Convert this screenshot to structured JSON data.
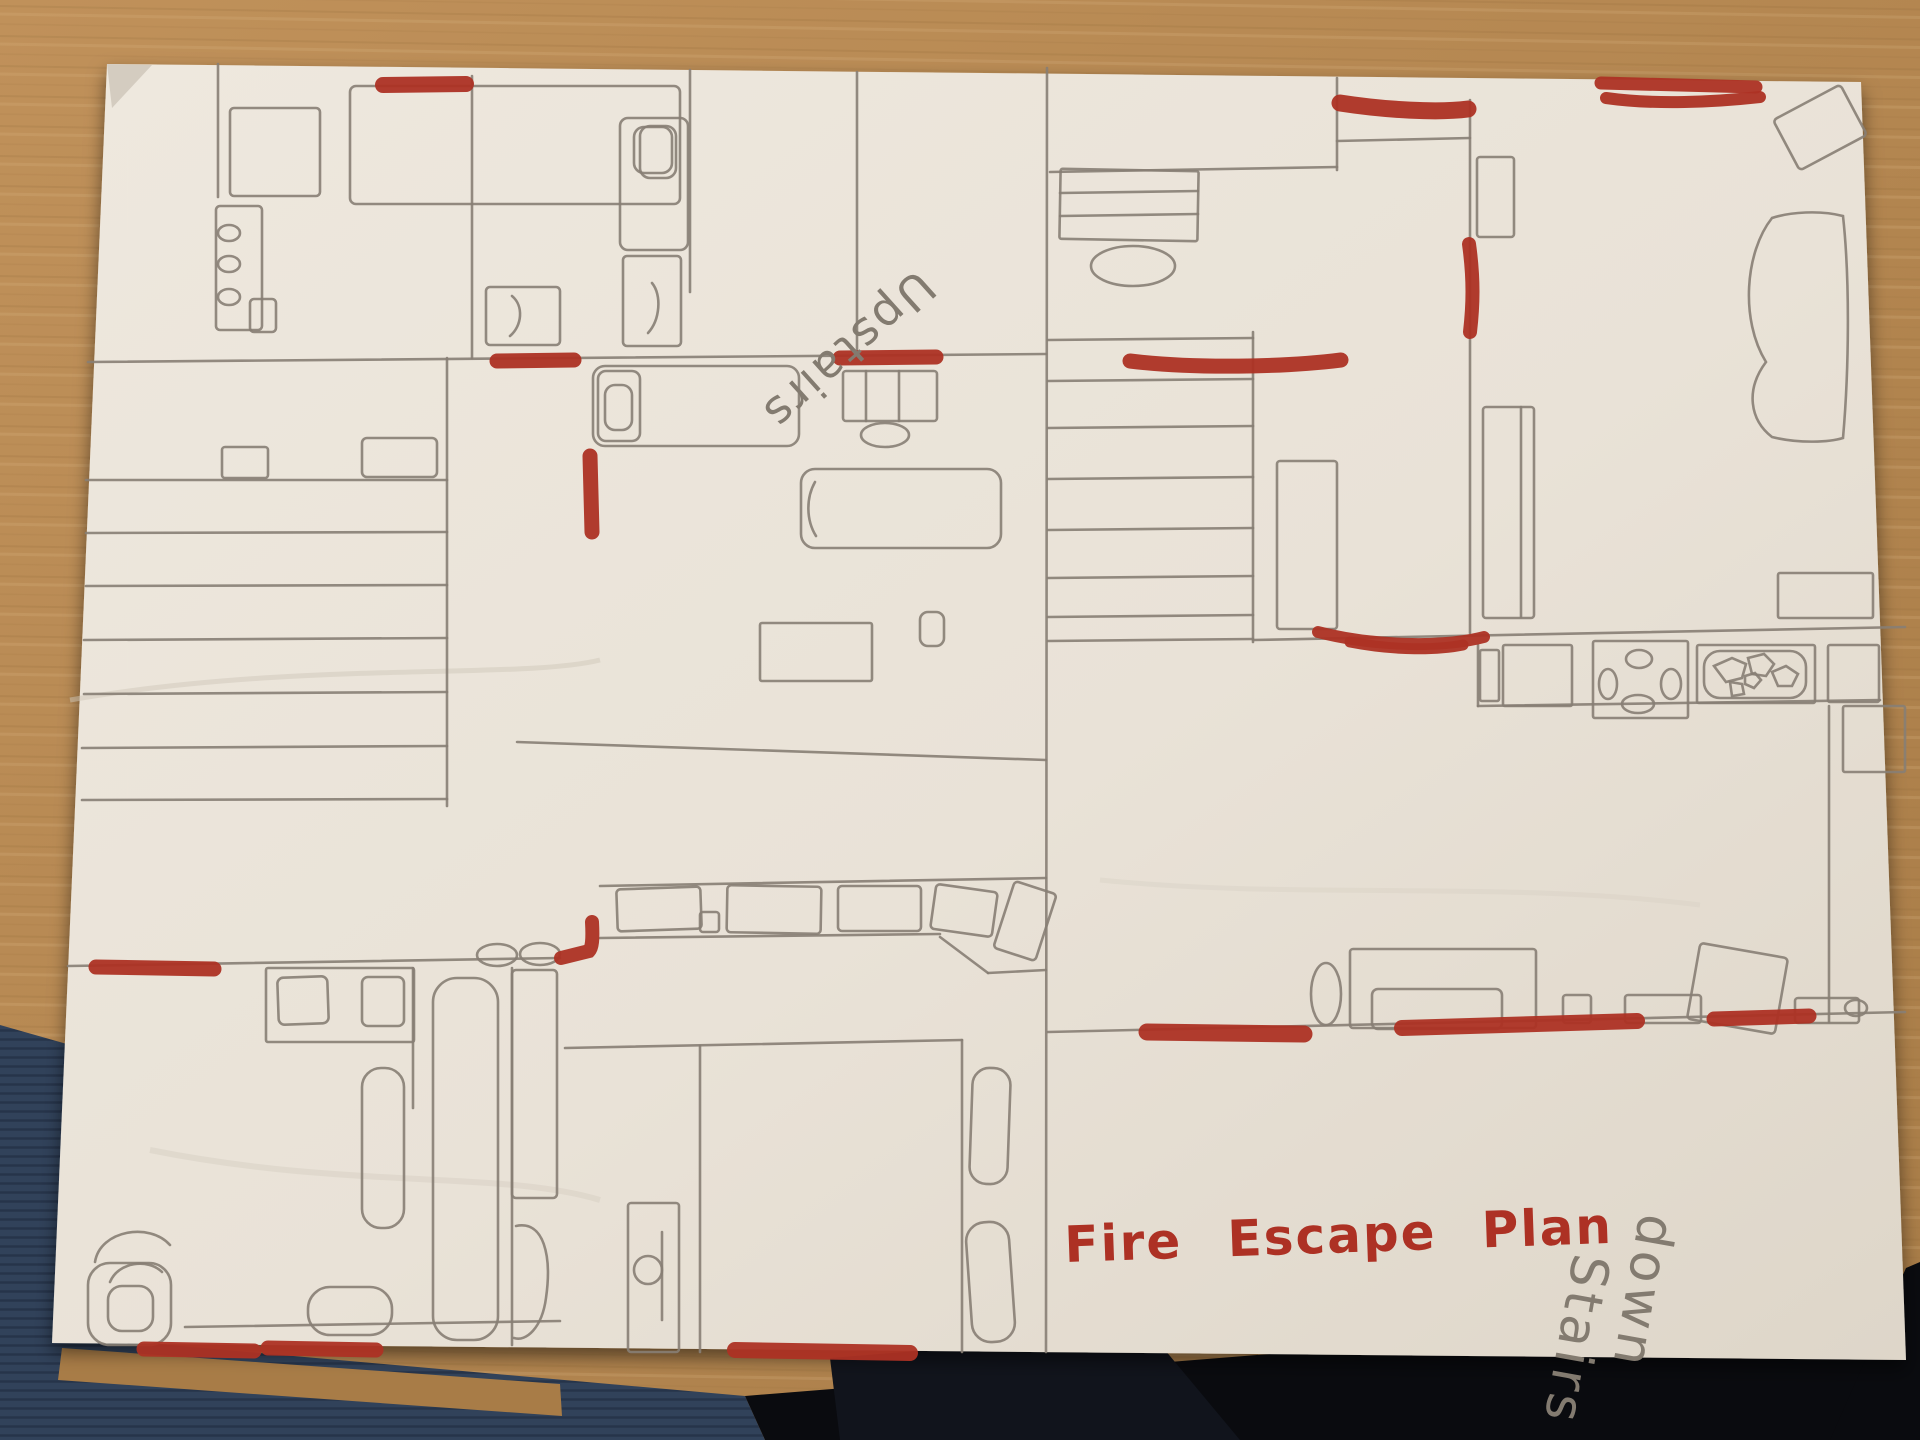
{
  "scene": {
    "description": "Photo of a hand-drawn fire escape plan on white paper lying on a wooden table",
    "floors": [
      "Upstairs",
      "down Stairs"
    ]
  },
  "palette": {
    "wood": "#c0915a",
    "wood_dark": "#a87c47",
    "wood_grain": "#8a6130",
    "wood_light": "#dab583",
    "fabric_navy": "#31425a",
    "fabric_line": "#26344a",
    "shadow_black": "#0a0b0f",
    "paper": "#e9e2d7",
    "paper_edge": "#d4ccc0",
    "pencil": "#877e74",
    "pencil_text": "#837b70",
    "marker_red": "#ad3124"
  },
  "texts": [
    {
      "name": "label-upstairs",
      "text": "Upstairs",
      "x": 917,
      "y": 268,
      "size": 46,
      "rot": 138,
      "color": "pencil_text",
      "weight": "normal",
      "spacing": 3,
      "word": 0
    },
    {
      "name": "label-downstairs-line1",
      "text": "down",
      "x": 1640,
      "y": 1212,
      "size": 52,
      "rot": 100,
      "color": "pencil_text",
      "weight": "normal",
      "spacing": 4,
      "word": 0
    },
    {
      "name": "label-downstairs-line2",
      "text": "Stairs",
      "x": 1574,
      "y": 1252,
      "size": 52,
      "rot": 100,
      "color": "pencil_text",
      "weight": "normal",
      "spacing": 4,
      "word": 0
    },
    {
      "name": "title-fire-escape-plan",
      "text": "Fire Escape Plan",
      "x": 1065,
      "y": 1262,
      "size": 50,
      "rot": -2,
      "color": "marker_red",
      "weight": "bold",
      "spacing": 2,
      "word": 26
    }
  ],
  "red_marks": [
    {
      "name": "exit-top-left-bedroom",
      "d": "M383,85 L466,84",
      "w": 16
    },
    {
      "name": "exit-top-right-wall",
      "d": "M1340,103 C1385,110 1438,113 1468,109",
      "w": 17
    },
    {
      "name": "exit-top-corner-stroke1",
      "d": "M1601,83 L1756,87",
      "w": 13
    },
    {
      "name": "exit-top-corner-stroke2",
      "d": "M1606,98 C1655,105 1715,102 1760,97",
      "w": 12
    },
    {
      "name": "exit-right-wall-vertical",
      "d": "M1469,244 C1474,280 1473,306 1470,332",
      "w": 14
    },
    {
      "name": "exit-midleft-door",
      "d": "M497,361 L574,360",
      "w": 15
    },
    {
      "name": "exit-center-door",
      "d": "M840,358 L936,357",
      "w": 15
    },
    {
      "name": "exit-right-of-center-door",
      "d": "M1130,361 C1195,369 1285,367 1341,360",
      "w": 15
    },
    {
      "name": "exit-middle-vertical-door",
      "d": "M590,456 L592,532",
      "w": 15
    },
    {
      "name": "exit-left-bathroom-wall",
      "d": "M96,967 L214,969",
      "w": 15
    },
    {
      "name": "exit-corridor-L-mark",
      "d": "M592,922 C593,940 592,948 589,951 L561,958",
      "w": 14
    },
    {
      "name": "exit-kitchen-curve1",
      "d": "M1318,632 C1372,646 1442,648 1484,637",
      "w": 12
    },
    {
      "name": "exit-kitchen-curve2",
      "d": "M1350,642 C1396,651 1438,650 1463,645",
      "w": 11
    },
    {
      "name": "exit-living-bottom-left",
      "d": "M1147,1032 L1304,1034",
      "w": 17
    },
    {
      "name": "exit-living-bottom-center",
      "d": "M1402,1028 L1637,1021",
      "w": 16
    },
    {
      "name": "exit-living-bottom-right",
      "d": "M1714,1019 L1809,1016",
      "w": 15
    },
    {
      "name": "exit-paper-bottom-center",
      "d": "M735,1350 L910,1353",
      "w": 16
    },
    {
      "name": "exit-bathroom-bottom1",
      "d": "M144,1349 L254,1351",
      "w": 15
    },
    {
      "name": "exit-bathroom-bottom2",
      "d": "M268,1348 L376,1350",
      "w": 15
    }
  ],
  "drawing": {
    "lines": [
      [
        88,
        362,
        1046,
        354
      ],
      [
        472,
        76,
        472,
        358
      ],
      [
        690,
        70,
        690,
        292
      ],
      [
        857,
        72,
        857,
        356
      ],
      [
        1047,
        68,
        1046,
        1352
      ],
      [
        218,
        64,
        218,
        197
      ],
      [
        447,
        358,
        447,
        806
      ],
      [
        86,
        480,
        447,
        480
      ],
      [
        86,
        533,
        447,
        532
      ],
      [
        86,
        586,
        447,
        585
      ],
      [
        84,
        640,
        447,
        638
      ],
      [
        84,
        694,
        447,
        692
      ],
      [
        82,
        748,
        447,
        746
      ],
      [
        82,
        800,
        447,
        799
      ],
      [
        68,
        966,
        560,
        958
      ],
      [
        940,
        937,
        988,
        973
      ],
      [
        988,
        973,
        1046,
        970
      ],
      [
        600,
        886,
        1046,
        878
      ],
      [
        600,
        938,
        940,
        934
      ],
      [
        565,
        1048,
        962,
        1040
      ],
      [
        700,
        1046,
        700,
        1352
      ],
      [
        962,
        1040,
        962,
        1352
      ],
      [
        517,
        742,
        1046,
        760
      ],
      [
        413,
        968,
        413,
        1108
      ],
      [
        512,
        968,
        512,
        1345
      ],
      [
        185,
        1327,
        560,
        1321
      ],
      [
        866,
        371,
        866,
        421
      ],
      [
        899,
        371,
        899,
        421
      ],
      [
        662,
        1232,
        662,
        1320
      ],
      [
        1050,
        172,
        1337,
        167
      ],
      [
        1337,
        78,
        1337,
        170
      ],
      [
        1337,
        141,
        1470,
        138
      ],
      [
        1470,
        100,
        1470,
        633
      ],
      [
        1253,
        332,
        1253,
        642
      ],
      [
        1048,
        340,
        1253,
        338
      ],
      [
        1048,
        381,
        1253,
        379
      ],
      [
        1048,
        428,
        1253,
        426
      ],
      [
        1048,
        479,
        1253,
        477
      ],
      [
        1048,
        530,
        1253,
        528
      ],
      [
        1048,
        578,
        1253,
        576
      ],
      [
        1048,
        617,
        1253,
        615
      ],
      [
        1048,
        641,
        1253,
        639
      ],
      [
        1253,
        640,
        1905,
        627
      ],
      [
        1478,
        706,
        1880,
        700
      ],
      [
        1478,
        645,
        1478,
        706
      ],
      [
        1829,
        706,
        1829,
        1022
      ],
      [
        1521,
        407,
        1521,
        617
      ],
      [
        1060,
        193,
        1198,
        191
      ],
      [
        1060,
        216,
        1198,
        214
      ],
      [
        1048,
        1032,
        1905,
        1012
      ]
    ],
    "rects": [
      {
        "n": "bed",
        "x": 350,
        "y": 86,
        "w": 330,
        "h": 118,
        "rx": 6
      },
      {
        "n": "pillow",
        "x": 640,
        "y": 126,
        "w": 36,
        "h": 52,
        "rx": 10
      },
      {
        "n": "wardrobe",
        "x": 230,
        "y": 108,
        "w": 90,
        "h": 88,
        "rx": 4
      },
      {
        "n": "shelf",
        "x": 216,
        "y": 206,
        "w": 46,
        "h": 124,
        "rx": 4
      },
      {
        "n": "bedside",
        "x": 250,
        "y": 299,
        "w": 26,
        "h": 33,
        "rx": 4
      },
      {
        "n": "bed",
        "x": 620,
        "y": 118,
        "w": 68,
        "h": 132,
        "rx": 8
      },
      {
        "n": "pillow",
        "x": 634,
        "y": 127,
        "w": 38,
        "h": 46,
        "rx": 10
      },
      {
        "n": "desk",
        "x": 623,
        "y": 256,
        "w": 58,
        "h": 90,
        "rx": 4
      },
      {
        "n": "desk",
        "x": 486,
        "y": 287,
        "w": 74,
        "h": 58,
        "rx": 4
      },
      {
        "n": "cabinet",
        "x": 222,
        "y": 447,
        "w": 46,
        "h": 31,
        "rx": 3
      },
      {
        "n": "cabinet",
        "x": 362,
        "y": 438,
        "w": 75,
        "h": 39,
        "rx": 5
      },
      {
        "n": "bed",
        "x": 593,
        "y": 366,
        "w": 206,
        "h": 80,
        "rx": 12
      },
      {
        "n": "pillow",
        "x": 598,
        "y": 371,
        "w": 42,
        "h": 70,
        "rx": 8
      },
      {
        "n": "pillow",
        "x": 605,
        "y": 385,
        "w": 27,
        "h": 45,
        "rx": 10
      },
      {
        "n": "dresser",
        "x": 843,
        "y": 371,
        "w": 94,
        "h": 50,
        "rx": 3
      },
      {
        "n": "sofa-bed",
        "x": 801,
        "y": 469,
        "w": 200,
        "h": 79,
        "rx": 14
      },
      {
        "n": "desk",
        "x": 760,
        "y": 623,
        "w": 112,
        "h": 58,
        "rx": 2
      },
      {
        "n": "side-table",
        "x": 920,
        "y": 612,
        "w": 24,
        "h": 34,
        "rx": 8
      },
      {
        "n": "wardrobe-unit",
        "x": 617,
        "y": 888,
        "w": 84,
        "h": 42,
        "rx": 4,
        "rot": -2
      },
      {
        "n": "wardrobe-unit",
        "x": 727,
        "y": 886,
        "w": 94,
        "h": 47,
        "rx": 4,
        "rot": 1
      },
      {
        "n": "wardrobe-unit",
        "x": 838,
        "y": 886,
        "w": 83,
        "h": 45,
        "rx": 4
      },
      {
        "n": "wardrobe-unit",
        "x": 700,
        "y": 912,
        "w": 19,
        "h": 20,
        "rx": 3
      },
      {
        "n": "wardrobe-unit",
        "x": 933,
        "y": 888,
        "w": 62,
        "h": 45,
        "rx": 4,
        "rot": 8
      },
      {
        "n": "wardrobe-unit",
        "x": 1003,
        "y": 886,
        "w": 44,
        "h": 70,
        "rx": 4,
        "rot": 18
      },
      {
        "n": "sink-unit",
        "x": 266,
        "y": 968,
        "w": 148,
        "h": 74,
        "rx": 2
      },
      {
        "n": "basin",
        "x": 278,
        "y": 977,
        "w": 50,
        "h": 47,
        "rx": 6,
        "rot": -2
      },
      {
        "n": "basin",
        "x": 362,
        "y": 977,
        "w": 42,
        "h": 49,
        "rx": 6
      },
      {
        "n": "bathtub",
        "x": 433,
        "y": 978,
        "w": 65,
        "h": 362,
        "rx": 24
      },
      {
        "n": "bathtub",
        "x": 362,
        "y": 1068,
        "w": 42,
        "h": 160,
        "rx": 19
      },
      {
        "n": "shower",
        "x": 512,
        "y": 970,
        "w": 45,
        "h": 228,
        "rx": 4
      },
      {
        "n": "toilet",
        "x": 88,
        "y": 1263,
        "w": 83,
        "h": 82,
        "rx": 22
      },
      {
        "n": "toilet",
        "x": 108,
        "y": 1286,
        "w": 45,
        "h": 45,
        "rx": 14
      },
      {
        "n": "toilet",
        "x": 308,
        "y": 1287,
        "w": 84,
        "h": 48,
        "rx": 22
      },
      {
        "n": "door",
        "x": 628,
        "y": 1203,
        "w": 51,
        "h": 149,
        "rx": 3
      },
      {
        "n": "rug",
        "x": 971,
        "y": 1068,
        "w": 38,
        "h": 116,
        "rx": 17,
        "rot": 2
      },
      {
        "n": "rug",
        "x": 969,
        "y": 1222,
        "w": 43,
        "h": 120,
        "rx": 19,
        "rot": -4
      },
      {
        "n": "desk",
        "x": 1060,
        "y": 170,
        "w": 138,
        "h": 70,
        "rx": 2,
        "rot": 1
      },
      {
        "n": "shelf",
        "x": 1477,
        "y": 157,
        "w": 37,
        "h": 80,
        "rx": 3
      },
      {
        "n": "wardrobe",
        "x": 1483,
        "y": 407,
        "w": 51,
        "h": 211,
        "rx": 3
      },
      {
        "n": "door",
        "x": 1277,
        "y": 461,
        "w": 60,
        "h": 168,
        "rx": 3
      },
      {
        "n": "window",
        "x": 1778,
        "y": 573,
        "w": 95,
        "h": 45,
        "rx": 2
      },
      {
        "n": "picture",
        "x": 1782,
        "y": 99,
        "w": 76,
        "h": 57,
        "rx": 4,
        "rot": -28
      },
      {
        "n": "counter-unit",
        "x": 1480,
        "y": 650,
        "w": 19,
        "h": 51,
        "rx": 2
      },
      {
        "n": "counter-unit",
        "x": 1503,
        "y": 645,
        "w": 69,
        "h": 61,
        "rx": 2
      },
      {
        "n": "stove",
        "x": 1593,
        "y": 641,
        "w": 95,
        "h": 77,
        "rx": 2
      },
      {
        "n": "sink-unit",
        "x": 1697,
        "y": 645,
        "w": 118,
        "h": 58,
        "rx": 2
      },
      {
        "n": "sink",
        "x": 1704,
        "y": 651,
        "w": 102,
        "h": 47,
        "rx": 16
      },
      {
        "n": "counter-unit",
        "x": 1828,
        "y": 645,
        "w": 51,
        "h": 57,
        "rx": 2
      },
      {
        "n": "counter-unit",
        "x": 1843,
        "y": 706,
        "w": 62,
        "h": 66,
        "rx": 2
      },
      {
        "n": "sofa",
        "x": 1350,
        "y": 949,
        "w": 186,
        "h": 79,
        "rx": 3
      },
      {
        "n": "sofa-seat",
        "x": 1372,
        "y": 989,
        "w": 130,
        "h": 40,
        "rx": 6
      },
      {
        "n": "table",
        "x": 1693,
        "y": 950,
        "w": 89,
        "h": 77,
        "rx": 4,
        "rot": 10
      },
      {
        "n": "cabinet",
        "x": 1563,
        "y": 995,
        "w": 28,
        "h": 28,
        "rx": 3
      },
      {
        "n": "cabinet",
        "x": 1625,
        "y": 995,
        "w": 76,
        "h": 28,
        "rx": 3
      },
      {
        "n": "cabinet",
        "x": 1795,
        "y": 998,
        "w": 64,
        "h": 25,
        "rx": 3
      }
    ],
    "ellipses": [
      {
        "n": "knob",
        "cx": 229,
        "cy": 233,
        "rx": 11,
        "ry": 8
      },
      {
        "n": "knob",
        "cx": 229,
        "cy": 264,
        "rx": 11,
        "ry": 8
      },
      {
        "n": "knob",
        "cx": 229,
        "cy": 297,
        "rx": 11,
        "ry": 8
      },
      {
        "n": "stool",
        "cx": 1133,
        "cy": 266,
        "rx": 42,
        "ry": 20
      },
      {
        "n": "stool",
        "cx": 885,
        "cy": 435,
        "rx": 24,
        "ry": 12
      },
      {
        "n": "door-arc",
        "cx": 497,
        "cy": 955,
        "rx": 20,
        "ry": 11
      },
      {
        "n": "door-arc",
        "cx": 540,
        "cy": 954,
        "rx": 20,
        "ry": 11
      },
      {
        "n": "burner",
        "cx": 1639,
        "cy": 659,
        "rx": 13,
        "ry": 9
      },
      {
        "n": "burner",
        "cx": 1608,
        "cy": 684,
        "rx": 9,
        "ry": 15
      },
      {
        "n": "burner",
        "cx": 1671,
        "cy": 684,
        "rx": 10,
        "ry": 15
      },
      {
        "n": "burner",
        "cx": 1638,
        "cy": 704,
        "rx": 16,
        "ry": 9
      },
      {
        "n": "side-table",
        "cx": 1326,
        "cy": 994,
        "rx": 15,
        "ry": 31
      },
      {
        "n": "knob",
        "cx": 1856,
        "cy": 1008,
        "rx": 11,
        "ry": 8
      },
      {
        "n": "door-knob",
        "cx": 648,
        "cy": 1270,
        "rx": 14,
        "ry": 14
      }
    ],
    "paths": [
      {
        "n": "chair-curve",
        "d": "M652,283 C662,295 660,320 648,333"
      },
      {
        "n": "chair-curve",
        "d": "M512,296 C524,306 522,326 510,336"
      },
      {
        "n": "sofa-curve",
        "d": "M815,482 C806,498 806,520 816,536"
      },
      {
        "n": "beanbag",
        "d": "M1772,218 C1745,252 1740,320 1766,362 C1745,390 1750,420 1772,437 C1800,444 1830,442 1843,438 C1849,370 1850,280 1843,216 C1820,210 1790,212 1772,218"
      },
      {
        "n": "toilet-arc",
        "d": "M95,1262 C100,1230 150,1222 170,1245"
      },
      {
        "n": "toilet-arc",
        "d": "M110,1282 C118,1262 148,1258 162,1272"
      },
      {
        "n": "chair-shape",
        "d": "M516,1226 C544,1220 552,1256 546,1298 C542,1328 526,1342 514,1338"
      },
      {
        "n": "pebble",
        "d": "M1714,666 l18,-8 l14,6 l-4,14 l-16,4 z"
      },
      {
        "n": "pebble",
        "d": "M1748,658 l16,-4 l10,10 l-8,12 l-14,-2 z"
      },
      {
        "n": "pebble",
        "d": "M1772,672 l14,-6 l12,8 l-6,12 l-14,0 z"
      },
      {
        "n": "pebble",
        "d": "M1730,682 l12,2 l2,10 l-12,2 z"
      },
      {
        "n": "pebble",
        "d": "M1745,676 l10,-3 l6,7 l-7,8 l-9,-4 z"
      }
    ]
  }
}
